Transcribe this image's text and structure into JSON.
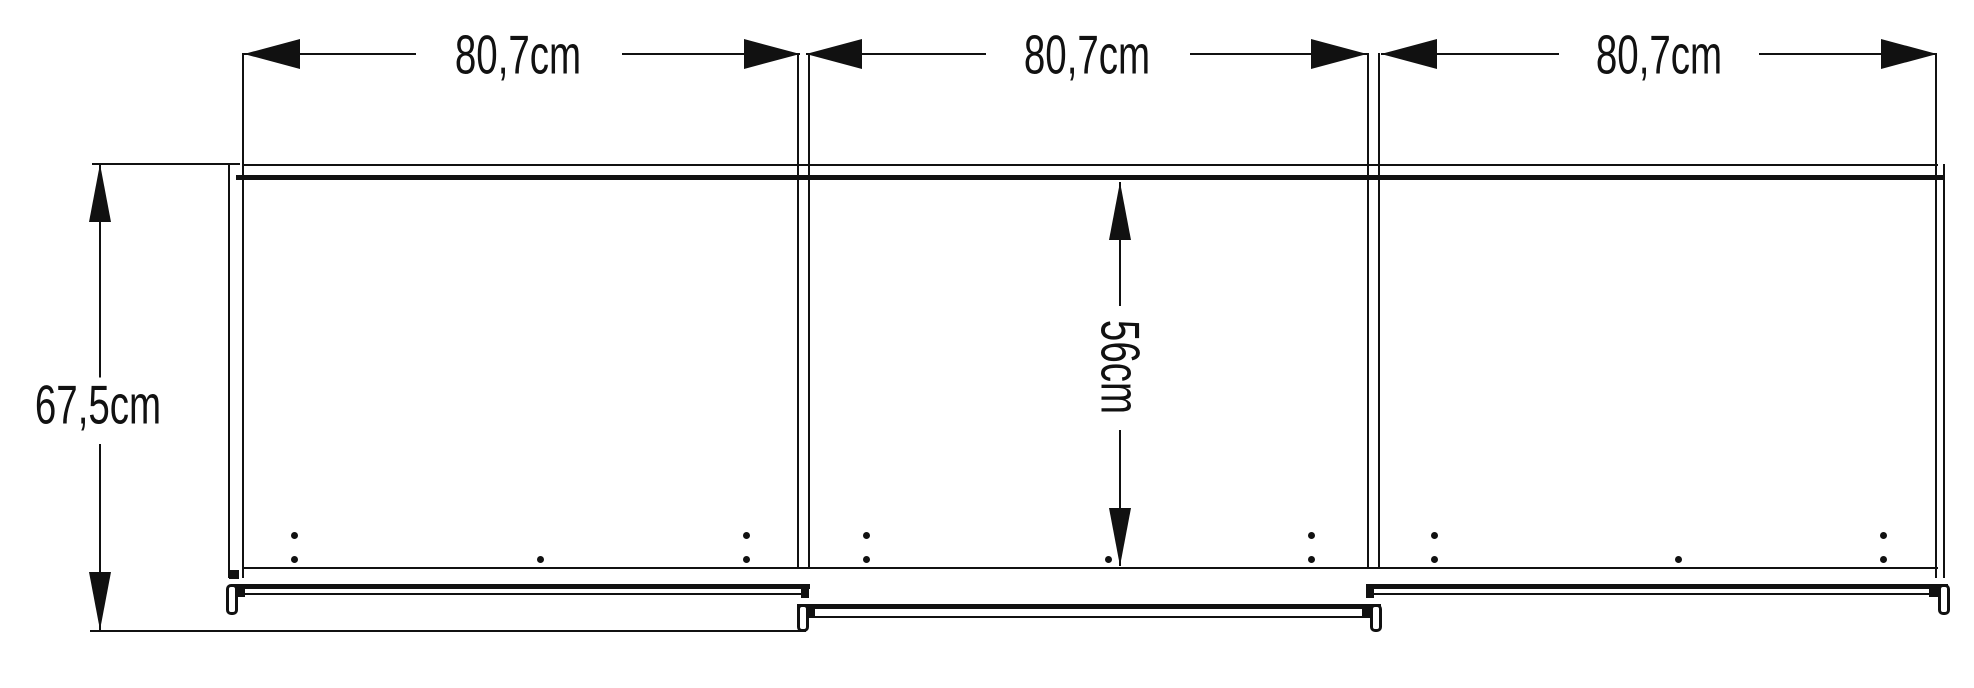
{
  "diagram": {
    "title": "Sliding-door wardrobe front elevation drawing",
    "type": "technical line drawing",
    "unit": "cm",
    "line_color": "#111111",
    "background_color": "#ffffff",
    "door_width_labels": [
      "80,7cm",
      "80,7cm",
      "80,7cm"
    ],
    "total_height_label": "67,5cm",
    "door_height_label": "56cm",
    "door_count": 3
  }
}
